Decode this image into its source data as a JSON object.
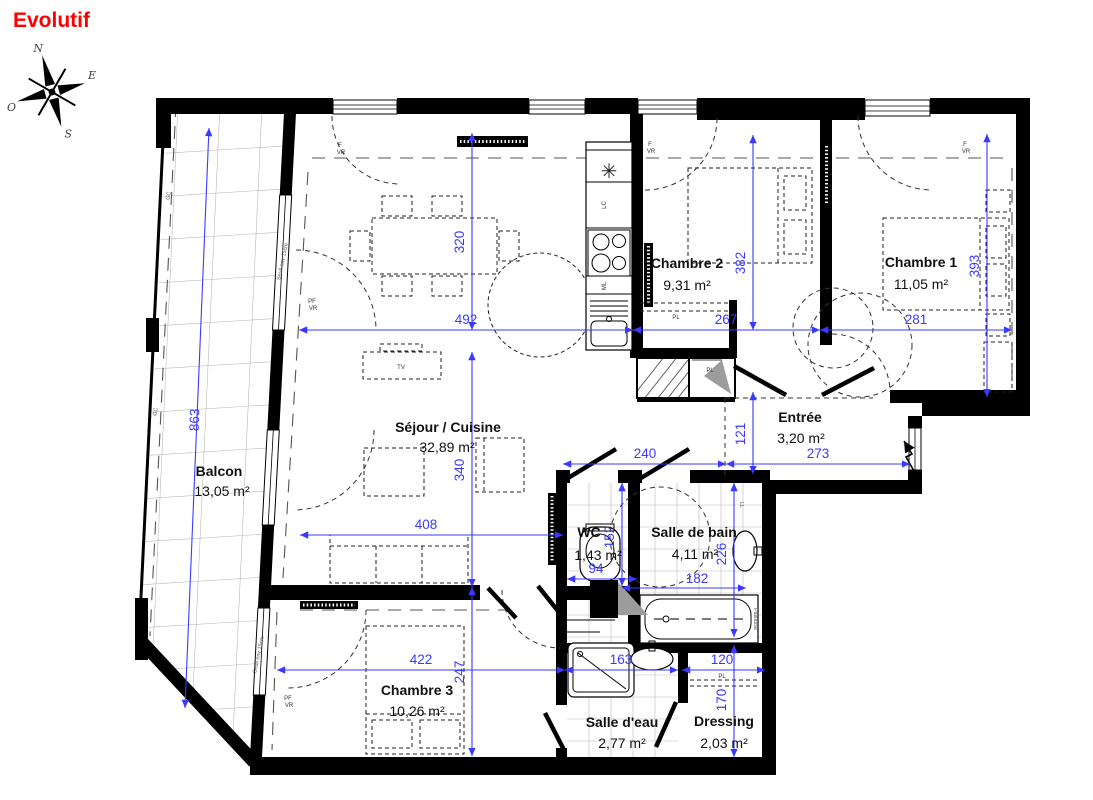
{
  "title": "Evolutif",
  "colors": {
    "dimension": "#3a3aff",
    "title": "#ff0000",
    "wall": "#000000"
  },
  "compass": {
    "north": "N",
    "east": "E",
    "south": "S",
    "west": "O"
  },
  "rooms": {
    "balcon": {
      "name": "Balcon",
      "area": "13,05 m²"
    },
    "sejour": {
      "name": "Séjour / Cuisine",
      "area": "32,89 m²"
    },
    "chambre1": {
      "name": "Chambre 1",
      "area": "11,05 m²"
    },
    "chambre2": {
      "name": "Chambre 2",
      "area": "9,31 m²"
    },
    "chambre3": {
      "name": "Chambre 3",
      "area": "10,26 m²"
    },
    "entree": {
      "name": "Entrée",
      "area": "3,20 m²"
    },
    "wc": {
      "name": "WC",
      "area": "1,43 m²"
    },
    "salle_de_bain": {
      "name": "Salle de bain",
      "area": "4,11 m²"
    },
    "salle_deau": {
      "name": "Salle d'eau",
      "area": "2,77 m²"
    },
    "dressing": {
      "name": "Dressing",
      "area": "2,03 m²"
    }
  },
  "dimensions_cm": {
    "d320": "320",
    "d492": "492",
    "d382": "382",
    "d267": "267",
    "d281": "281",
    "d393": "393",
    "d863": "863",
    "d340": "340",
    "d408": "408",
    "d121": "121",
    "d273": "273",
    "d240": "240",
    "d152": "152",
    "d94": "94",
    "d226": "226",
    "d182": "182",
    "d422": "422",
    "d247": "247",
    "d163": "163",
    "d120": "120",
    "d170": "170"
  },
  "annotations": {
    "f": "F",
    "vr": "VR",
    "pf": "PF",
    "seuil": "Seuil env 15cm",
    "gc": "GC",
    "tv": "TV",
    "lc": "LC",
    "ml": "ML",
    "ll": "LL",
    "pl": "PL",
    "paillasse": "Paillasse"
  }
}
